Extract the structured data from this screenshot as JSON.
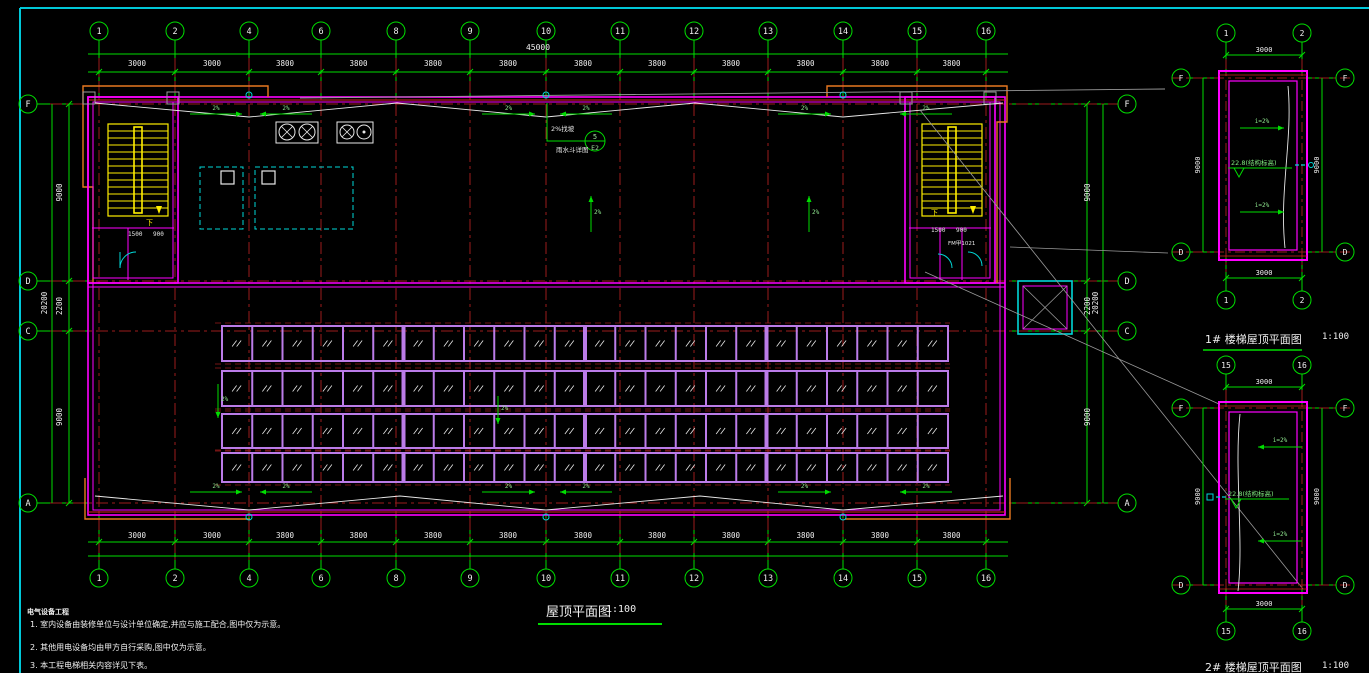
{
  "sheet": {
    "main_title": "屋顶平面图",
    "main_scale": "1:100",
    "detail1_title": "1# 楼梯屋顶平面图",
    "detail1_scale": "1:100",
    "detail2_title": "2# 楼梯屋顶平面图",
    "detail2_scale": "1:100"
  },
  "notes": {
    "header": "电气设备工程",
    "item1": "1. 室内设备由装修单位与设计单位确定,并应与施工配合,图中仅为示意。",
    "item2": "2. 其他用电设备均由甲方自行采购,图中仅为示意。",
    "item3": "3. 本工程电梯相关内容详见下表。"
  },
  "callout": {
    "top": "5",
    "bottom": "E2",
    "slope_note": "2%找坡",
    "drain_note": "雨水斗详图"
  },
  "levels": {
    "structural": "22.8(结构标高)"
  },
  "labels": {
    "slope": "i=2%",
    "pct": "2%",
    "down": "下",
    "dim_a": "1500",
    "dim_b": "900",
    "door_tag": "FM甲1021"
  },
  "axes": {
    "labels": [
      "1",
      "2",
      "4",
      "6",
      "8",
      "9",
      "10",
      "11",
      "12",
      "13",
      "14",
      "15",
      "16"
    ],
    "x": [
      99,
      175,
      249,
      321,
      396,
      470,
      546,
      620,
      694,
      768,
      843,
      917,
      986
    ],
    "bay_dims": [
      "3000",
      "3000",
      "3800",
      "3800",
      "3800",
      "3800",
      "3800",
      "3800",
      "3800",
      "3800",
      "3800",
      "3800"
    ],
    "total": "45000",
    "bubble_top_y": 31,
    "bubble_bot_y": 578
  },
  "rows": {
    "labels": [
      "F",
      "D",
      "C",
      "A"
    ],
    "y": [
      104,
      281,
      331,
      503
    ],
    "dims": [
      "9000",
      "2200",
      "9000"
    ],
    "total": "20200"
  },
  "panels": {
    "x0": 222,
    "cols": 24,
    "w": 30.25,
    "rows": [
      [
        326,
        35
      ],
      [
        371,
        35
      ],
      [
        414,
        34
      ],
      [
        453,
        29
      ]
    ],
    "group": 6
  },
  "drains_x": [
    249,
    546,
    843
  ],
  "h_arrow_rows": [
    114,
    492
  ],
  "h_arrow_segs": [
    [
      190,
      242
    ],
    [
      312,
      260
    ],
    [
      482,
      535
    ],
    [
      612,
      560
    ],
    [
      778,
      831
    ],
    [
      952,
      900
    ]
  ],
  "v_arrows": [
    {
      "x": 591,
      "y1": 232,
      "y2": 196
    },
    {
      "x": 809,
      "y1": 232,
      "y2": 196
    },
    {
      "x": 218,
      "y1": 384,
      "y2": 418
    },
    {
      "x": 498,
      "y1": 396,
      "y2": 424
    }
  ],
  "details": [
    {
      "cols": [
        "1",
        "2"
      ],
      "letters": [
        "F",
        "D"
      ],
      "top_dim": "3000",
      "bottom_dim": "3000",
      "side_dim": "9000",
      "ax": [
        1226,
        1302
      ],
      "cy_top": 33,
      "cy_bot": 300,
      "rect": [
        1219,
        71,
        88,
        189
      ],
      "letter_y": [
        78,
        252
      ],
      "curve": "M1288,86 C1293,140 1279,190 1285,248",
      "arrow_dir": "right",
      "arrow_y": [
        128,
        212
      ],
      "level_xy": [
        1231,
        163
      ],
      "cyan_y": 165,
      "cyan_side": "right"
    },
    {
      "cols": [
        "15",
        "16"
      ],
      "letters": [
        "F",
        "D"
      ],
      "top_dim": "3000",
      "bottom_dim": "3000",
      "side_dim": "9000",
      "ax": [
        1226,
        1302
      ],
      "cy_top": 365,
      "cy_bot": 631,
      "rect": [
        1219,
        402,
        88,
        191
      ],
      "letter_y": [
        408,
        585
      ],
      "curve": "M1240,414 C1234,470 1244,540 1238,591",
      "arrow_dir": "left",
      "arrow_y": [
        447,
        541
      ],
      "level_xy": [
        1228,
        494
      ],
      "cyan_y": 497,
      "cyan_side": "left"
    }
  ],
  "colors": {
    "green": "#00dd00",
    "magenta": "#ff00ff",
    "panel": "#bb7ce8",
    "yellow": "#ffee00",
    "cyan": "#00d8d8",
    "orange": "#e87820",
    "axis_red": "#9b1b1b",
    "red": "#dd2222",
    "white": "#e8e8e8",
    "gray": "#9a9a9a",
    "dimtext": "#f0f0f0"
  }
}
